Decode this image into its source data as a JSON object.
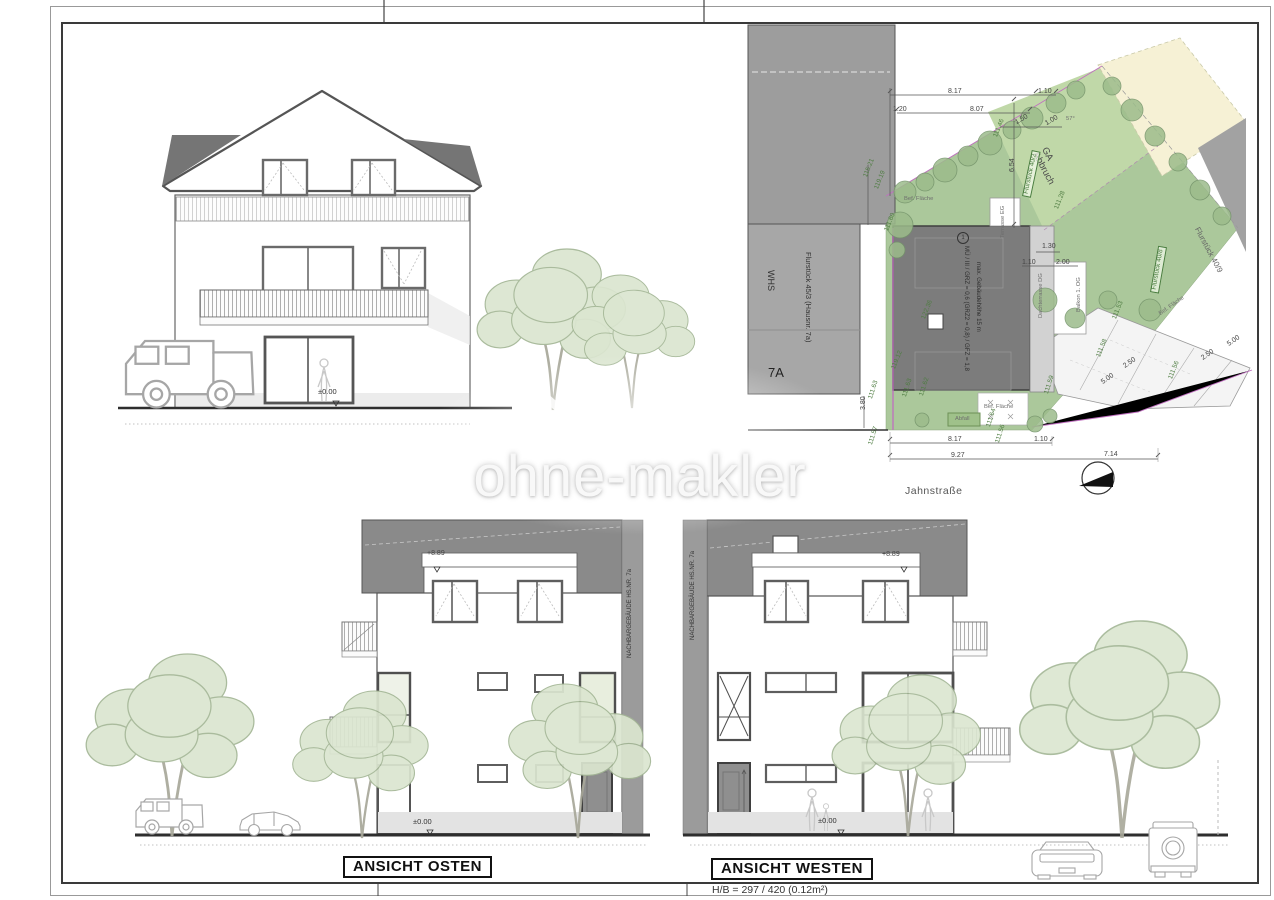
{
  "sheet": {
    "hb_note": "H/B = 297 / 420 (0.12m²)"
  },
  "watermark": {
    "text": "ohne-makler"
  },
  "top_elevation": {
    "zero": "±0.00"
  },
  "east_elevation": {
    "title": "ANSICHT OSTEN",
    "ridge": "+8.89",
    "zero": "±0.00",
    "neighbor": "NACHBARGEBÄUDE HS.NR. 7a"
  },
  "west_elevation": {
    "title": "ANSICHT WESTEN",
    "ridge": "+8.89",
    "zero": "±0.00",
    "neighbor": "NACHBARGEBÄUDE HS.NR. 7a"
  },
  "siteplan": {
    "street_label": "Jahnstraße",
    "building_7a": {
      "name": "WHS",
      "parcel": "Flurstück 45/3 (Hausnr. 7a)",
      "number": "7A"
    },
    "new_building": {
      "index": "1",
      "line1": "MÜ / III / GRZ = 0,6 (GRZ2 = 0,8) / GFZ = 1,8",
      "line2": "max. Gebäudehöhe 15 m"
    },
    "parcels": {
      "p402": "Flurstück 40/2",
      "p408": "Flurstück 40/8",
      "p409": "Flurstück 40/9",
      "ga": "GA\nAbbruch"
    },
    "dims": [
      {
        "t": "8.17",
        "x": 948,
        "y": 88,
        "r": 0
      },
      {
        "t": "1.10",
        "x": 1038,
        "y": 88,
        "r": 0
      },
      {
        "t": "1.20",
        "x": 893,
        "y": 106,
        "r": 0
      },
      {
        "t": "8.07",
        "x": 970,
        "y": 106,
        "r": 0
      },
      {
        "t": "1.50",
        "x": 1014,
        "y": 120,
        "r": -30
      },
      {
        "t": "1.00",
        "x": 1044,
        "y": 121,
        "r": -30
      },
      {
        "t": "6.54",
        "x": 1009,
        "y": 172,
        "r": -90
      },
      {
        "t": "1.30",
        "x": 1042,
        "y": 243,
        "r": 0
      },
      {
        "t": "1.10",
        "x": 1022,
        "y": 259,
        "r": 0
      },
      {
        "t": "2.00",
        "x": 1056,
        "y": 259,
        "r": 0
      },
      {
        "t": "3.80",
        "x": 860,
        "y": 410,
        "r": -90
      },
      {
        "t": "8.17",
        "x": 948,
        "y": 436,
        "r": 0
      },
      {
        "t": "1.10",
        "x": 1034,
        "y": 436,
        "r": 0
      },
      {
        "t": "9.27",
        "x": 951,
        "y": 452,
        "r": 0
      },
      {
        "t": "7.14",
        "x": 1104,
        "y": 451,
        "r": 0
      },
      {
        "t": "5.00",
        "x": 1100,
        "y": 380,
        "r": -35
      },
      {
        "t": "2.50",
        "x": 1122,
        "y": 364,
        "r": -35
      },
      {
        "t": "5.00",
        "x": 1226,
        "y": 342,
        "r": -35
      },
      {
        "t": "2.50",
        "x": 1200,
        "y": 356,
        "r": -35
      }
    ],
    "heights": [
      {
        "t": "115.21",
        "x": 863,
        "y": 176,
        "r": -68
      },
      {
        "t": "119.19",
        "x": 874,
        "y": 188,
        "r": -68
      },
      {
        "t": "111.60",
        "x": 884,
        "y": 230,
        "r": -68
      },
      {
        "t": "111.46",
        "x": 993,
        "y": 136,
        "r": -68
      },
      {
        "t": "111.28",
        "x": 1054,
        "y": 208,
        "r": -68
      },
      {
        "t": "122.36",
        "x": 921,
        "y": 318,
        "r": -68
      },
      {
        "t": "119.12",
        "x": 891,
        "y": 368,
        "r": -68
      },
      {
        "t": "111.63",
        "x": 868,
        "y": 398,
        "r": -72
      },
      {
        "t": "111.63",
        "x": 902,
        "y": 396,
        "r": -72
      },
      {
        "t": "111.62",
        "x": 919,
        "y": 395,
        "r": -72
      },
      {
        "t": "111.59",
        "x": 1044,
        "y": 393,
        "r": -72
      },
      {
        "t": "111.64",
        "x": 986,
        "y": 426,
        "r": -72
      },
      {
        "t": "111.56",
        "x": 995,
        "y": 442,
        "r": -72
      },
      {
        "t": "111.57",
        "x": 868,
        "y": 444,
        "r": -72
      },
      {
        "t": "111.53",
        "x": 1112,
        "y": 318,
        "r": -68
      },
      {
        "t": "111.58",
        "x": 1096,
        "y": 356,
        "r": -68
      },
      {
        "t": "111.56",
        "x": 1168,
        "y": 378,
        "r": -68
      }
    ],
    "small_labels": [
      {
        "t": "Bef. Fläche",
        "x": 904,
        "y": 196,
        "r": 0
      },
      {
        "t": "Terrasse EG",
        "x": 1000,
        "y": 238,
        "r": -90
      },
      {
        "t": "Dachterrasse DG",
        "x": 1038,
        "y": 318,
        "r": -90
      },
      {
        "t": "Balkon 1. OG",
        "x": 1076,
        "y": 312,
        "r": -90
      },
      {
        "t": "Bef. Fläche",
        "x": 984,
        "y": 404,
        "r": 0
      },
      {
        "t": "Abfall",
        "x": 955,
        "y": 416,
        "r": 0
      },
      {
        "t": "Bef. Fläche",
        "x": 1158,
        "y": 312,
        "r": -35
      },
      {
        "t": "57°",
        "x": 1066,
        "y": 116,
        "r": 0
      }
    ]
  }
}
